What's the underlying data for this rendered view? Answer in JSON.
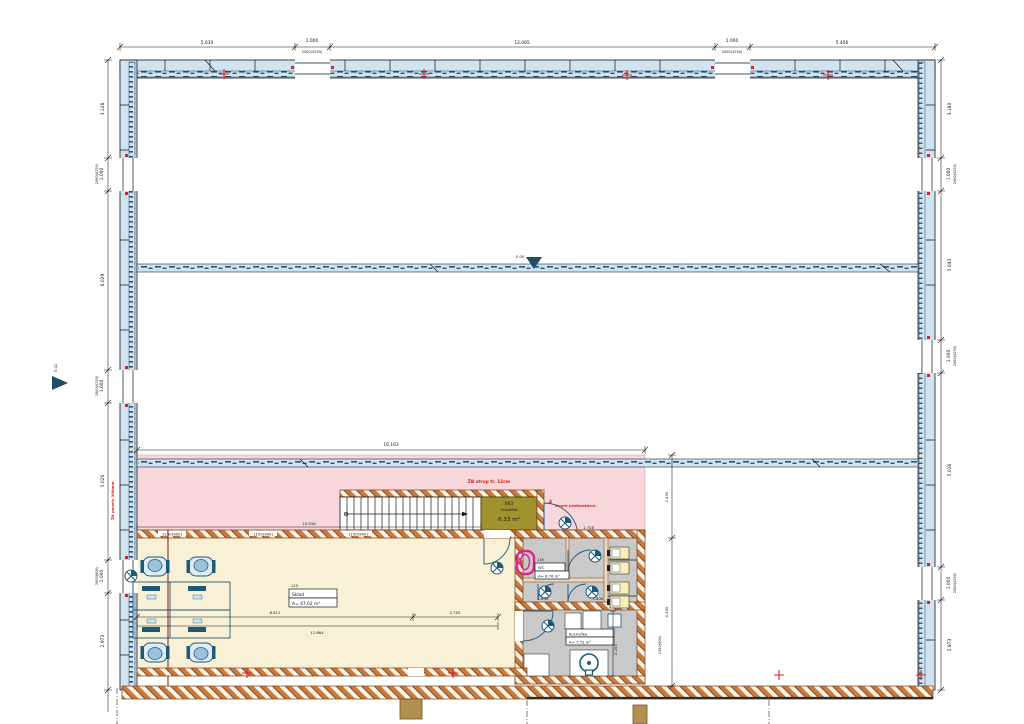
{
  "drawing": {
    "type": "architectural-floor-plan",
    "colors": {
      "wall_fill": "#cfe3f1",
      "wall_speck": "#23567a",
      "outline": "#16181d",
      "slab_pink": "#f8d7dc",
      "office_cream": "#f8f1d6",
      "room_gray": "#c9c9c9",
      "stair_olive": "#a2922f",
      "brick_hatch": "#c97b3d",
      "accent_red": "#d92121",
      "section_red": "#7a1515",
      "symbol_blue": "#1d5a7a",
      "fixture_yellow": "#f6efb9",
      "fixture_magenta": "#e0218a",
      "wood_tan": "#b3904f"
    },
    "markers": {
      "e00": "E-00",
      "e02": "E-02"
    },
    "notes": {
      "slab": "ŽB strop tl. 12cm",
      "fire_door_index": "4",
      "fire_door": "Dveře protipožární.",
      "wall_panels": "ŽB panely 300mm"
    },
    "rooms": {
      "stairs": {
        "number": "063",
        "name": "Schodiště",
        "area": "6.33 m²"
      },
      "storage": {
        "number": "115",
        "name": "Sklad",
        "area": "A= 47.02 m²"
      },
      "wc": {
        "number": "116",
        "name": "WC",
        "area": "A= 6.76 m²"
      },
      "kitchen": {
        "name": "Kuchyňka",
        "area": "A= 7.72 m²"
      }
    },
    "dims": {
      "top": {
        "s1": "5.030",
        "w1": "1.000",
        "w1sub": "2000(4250)",
        "s2": "12.065",
        "w2": "1.000",
        "w2sub": "2000(4250)",
        "s3": "5.406"
      },
      "left": {
        "s1": "3.128",
        "w1": "1.000",
        "w1sub": "2000(4250)",
        "s2": "6.029",
        "w2": "1.000",
        "w2sub": "2000(4250)",
        "s3": "5.020",
        "w3": "1.000",
        "w3sub": "2000(900)",
        "s4": "2.973"
      },
      "right": {
        "s1": "3.180",
        "w1": "1.000",
        "w1sub": "2000(4250)",
        "s2": "5.043",
        "w2": "1.000",
        "w2sub": "2000(4250)",
        "s3": "5.026",
        "w3": "1.000",
        "w3sub": "2000(4250)",
        "s4": "2.973"
      },
      "interior": {
        "slab_width": "16.163",
        "office_width": "10.936",
        "lintel": "1150(900)",
        "office_a": "8.911",
        "office_b": "2.752",
        "office_total": "11.664",
        "hall_a": "2.400",
        "hall_b": "4.300",
        "hall_lintel": "1150(900)",
        "wc_a": "1.650",
        "wc_b": "1.830",
        "stair_door": "1.728",
        "stair_width": "900",
        "kitchen_depth": "2.200"
      }
    }
  }
}
